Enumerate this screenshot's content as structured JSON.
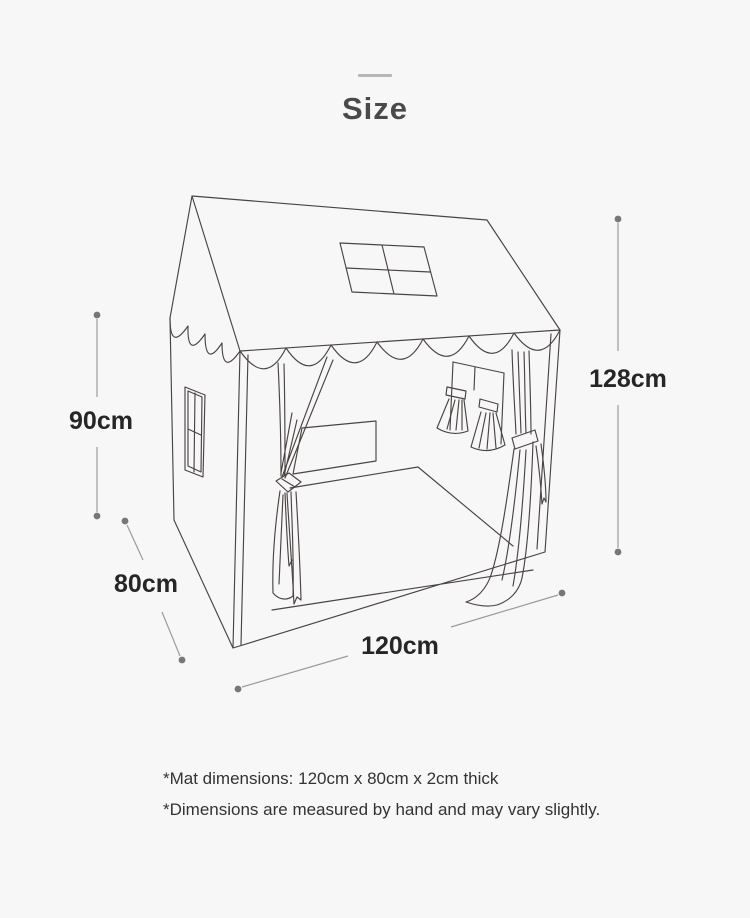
{
  "header": {
    "title": "Size"
  },
  "diagram": {
    "subject_name": "house-play-tent-line-drawing",
    "dimensions": {
      "height": "128cm",
      "side_height": "90cm",
      "depth": "80cm",
      "width": "120cm"
    },
    "colors": {
      "background": "#f7f7f7",
      "line_art": "#4a4443",
      "dimension_line": "#9b9b9b",
      "dimension_dot": "#777777",
      "label_text": "#262626",
      "title_text": "#4a4a4a",
      "divider_dash": "#b7b7b7"
    }
  },
  "footnotes": [
    "*Mat dimensions: 120cm x 80cm x 2cm thick",
    "*Dimensions are measured by hand and may vary slightly."
  ]
}
